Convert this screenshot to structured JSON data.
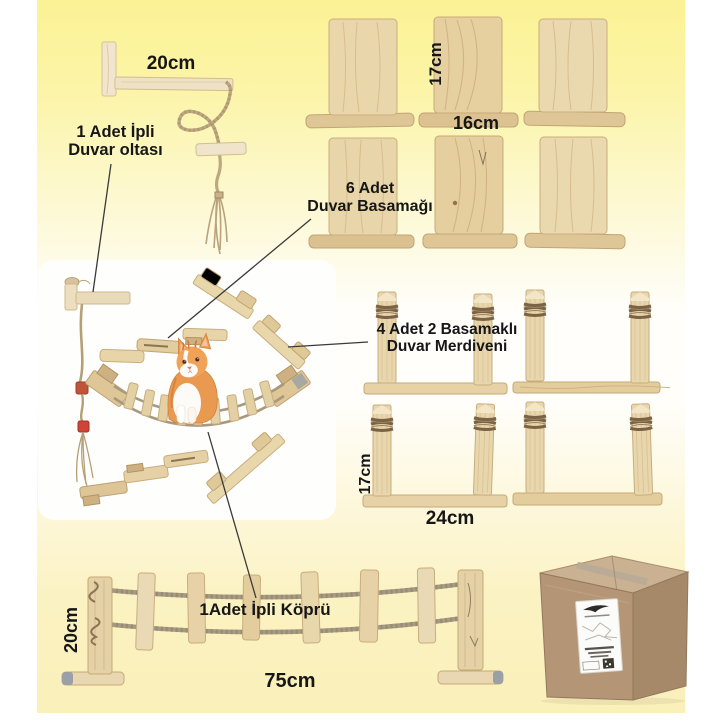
{
  "figure": {
    "rope_rod": {
      "width_label": "20cm",
      "caption_line1": "1 Adet İpli",
      "caption_line2": "Duvar oltası"
    },
    "wall_steps": {
      "height_label": "17cm",
      "width_label": "16cm",
      "caption_line1": "6 Adet",
      "caption_line2": "Duvar Basamağı"
    },
    "wall_ladders": {
      "caption_line1": "4 Adet 2 Basamaklı",
      "caption_line2": "Duvar Merdiveni",
      "height_label": "17cm",
      "width_label": "24cm"
    },
    "rope_bridge": {
      "height_label": "20cm",
      "caption": "1Adet İpli Köprü",
      "width_label": "75cm"
    }
  },
  "colors": {
    "bg_top_yellow": "#fbf295",
    "bg_bottom_yellow": "#faf0ba",
    "wood_light": "#ead8ad",
    "wood_base": "#dcc294",
    "rope_twine": "#a8997e",
    "dark_twine": "#7b6244",
    "cardboard_front": "#b49677",
    "label_text": "#161616",
    "kitten_orange": "#ea9a50"
  }
}
